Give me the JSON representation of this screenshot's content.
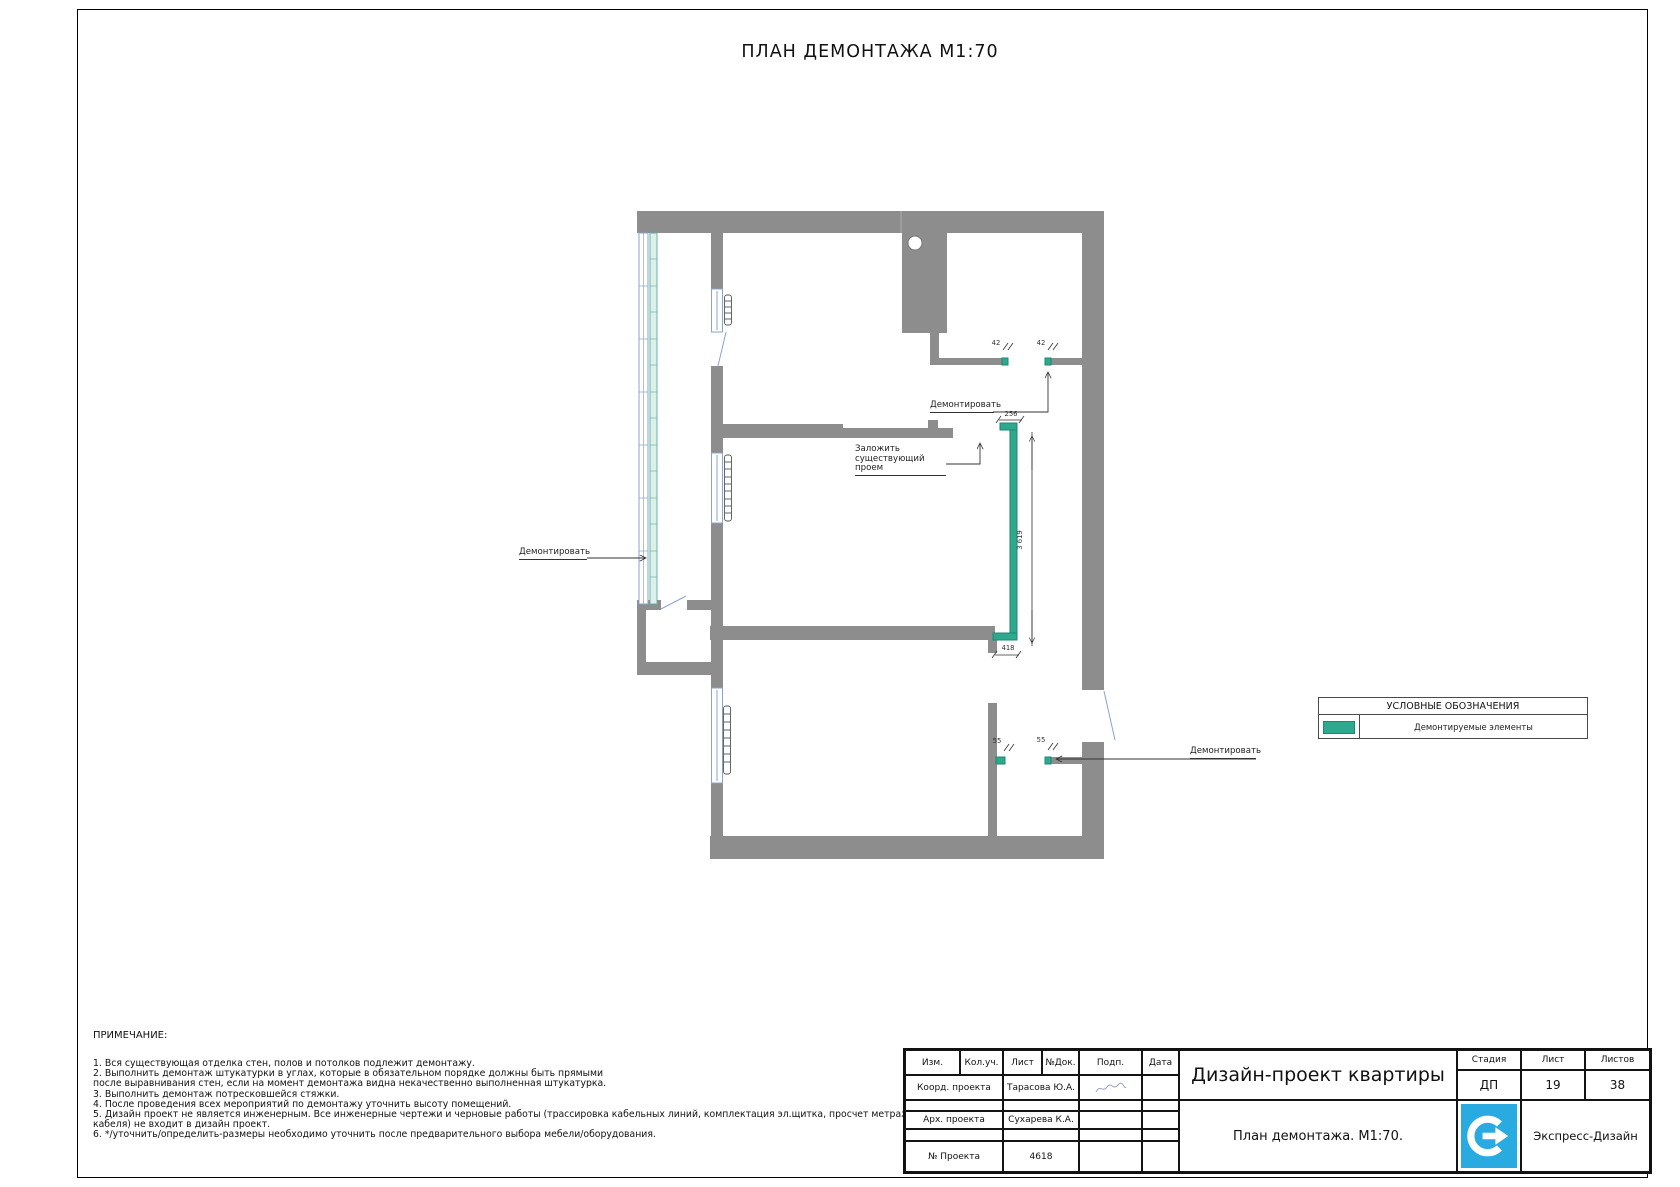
{
  "sheet": {
    "title": "ПЛАН ДЕМОНТАЖА М1:70"
  },
  "plan": {
    "labels": {
      "demolish_left": "Демонтировать",
      "demolish_top": "Демонтировать",
      "demolish_bottom": "Демонтировать",
      "fill_opening": "Заложить\nсуществующий проем"
    },
    "dims": {
      "w42_left": "42",
      "w42_right": "42",
      "w256": "256",
      "h3619": "3 619",
      "w418": "418",
      "w55_left": "55",
      "w55_right": "55"
    },
    "colors": {
      "wall": "#8d8d8d",
      "demolition": "#2fa98e",
      "window_outline": "#8aa4cf",
      "glazing": "#57b19d"
    }
  },
  "legend": {
    "title": "УСЛОВНЫЕ ОБОЗНАЧЕНИЯ",
    "item": "Демонтируемые элементы"
  },
  "notes": {
    "title": "ПРИМЕЧАНИЕ:",
    "lines": [
      "1. Вся существующая отделка стен, полов и потолков подлежит демонтажу.",
      "2. Выполнить демонтаж штукатурки в углах, которые в обязательном порядке должны быть прямыми",
      "после выравнивания стен, если на момент демонтажа видна некачественно выполненная штукатурка.",
      "3. Выполнить демонтаж потресковшейся стяжки.",
      "4. После проведения всех мероприятий по демонтажу уточнить высоту помещений.",
      "5. Дизайн проект не является инженерным. Все инженерные чертежи и черновые работы (трассировка кабельных линий, комплектация эл.щитка, просчет метража",
      "кабеля) не входит в дизайн проект.",
      "6. */уточнить/определить-размеры необходимо уточнить после предварительного выбора мебели/оборудования."
    ]
  },
  "titleblock": {
    "col_izm": "Изм.",
    "col_koluch": "Кол.уч.",
    "col_list": "Лист",
    "col_ndok": "№Док.",
    "col_podp": "Подп.",
    "col_data": "Дата",
    "coord_label": "Коорд. проекта",
    "coord_value": "Тарасова Ю.А.",
    "arch_label": "Арх. проекта",
    "arch_value": "Сухарева К.А.",
    "project_no_label": "№ Проекта",
    "project_no_value": "4618",
    "project_title": "Дизайн-проект квартиры",
    "sheet_name": "План демонтажа. М1:70.",
    "stage_label": "Стадия",
    "list_label": "Лист",
    "listov_label": "Листов",
    "stage_value": "ДП",
    "list_value": "19",
    "listov_value": "38",
    "company": "Экспресс-Дизайн",
    "logo_color": "#29abe2"
  }
}
